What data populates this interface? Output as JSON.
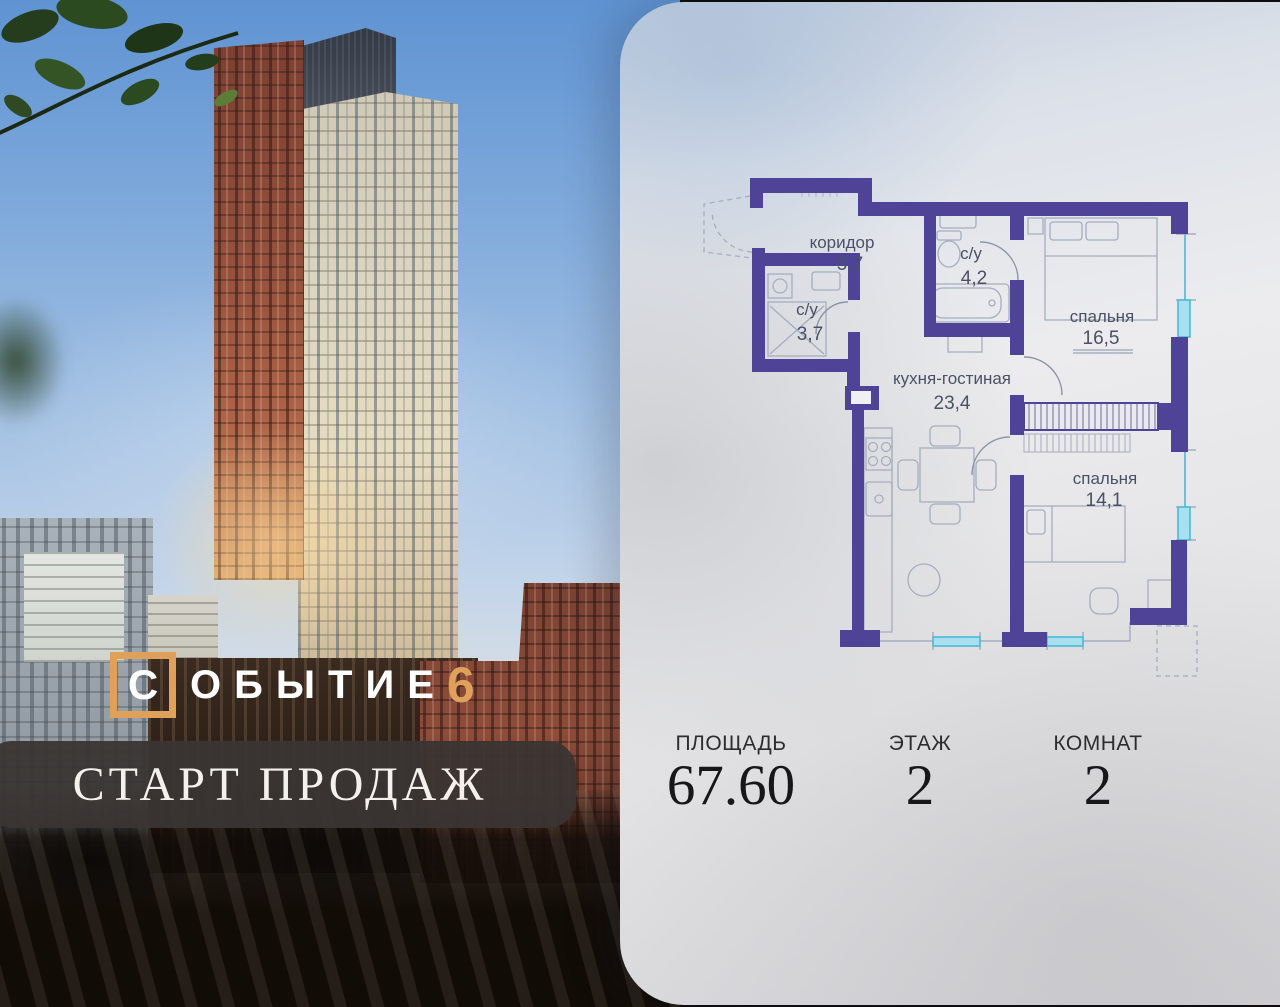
{
  "brand": {
    "name_first_letter": "С",
    "name_rest": "ОБЫТИЕ",
    "project_number": "6",
    "banner_text": "СТАРТ ПРОДАЖ",
    "accent_color": "#dfa05c"
  },
  "floor_plan": {
    "wall_color": "#4f4398",
    "window_color": "#49b9d6",
    "rooms": [
      {
        "id": "corridor",
        "name": "коридор",
        "area": "5,7"
      },
      {
        "id": "bathroom-1",
        "name": "с/у",
        "area": "4,2"
      },
      {
        "id": "bathroom-2",
        "name": "с/у",
        "area": "3,7"
      },
      {
        "id": "kitchen-living",
        "name": "кухня-гостиная",
        "area": "23,4"
      },
      {
        "id": "bedroom-1",
        "name": "спальня",
        "area": "16,5"
      },
      {
        "id": "bedroom-2",
        "name": "спальня",
        "area": "14,1"
      }
    ]
  },
  "stats": {
    "items": [
      {
        "label": "ПЛОЩАДЬ",
        "value": "67.60"
      },
      {
        "label": "ЭТАЖ",
        "value": "2"
      },
      {
        "label": "КОМНАТ",
        "value": "2"
      }
    ]
  }
}
